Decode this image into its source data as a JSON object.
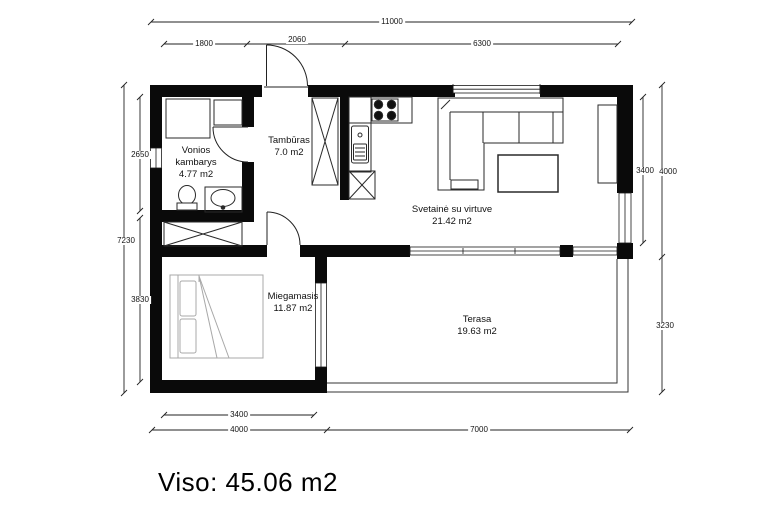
{
  "title": "House floor plan",
  "total": {
    "label": "Viso: 45.06 m2"
  },
  "rooms": {
    "bathroom": {
      "name": "Vonios kambarys",
      "area": "4.77 m2"
    },
    "hallway": {
      "name": "Tambūras",
      "area": "7.0 m2"
    },
    "living": {
      "name": "Svetainė su virtuve",
      "area": "21.42 m2"
    },
    "bedroom": {
      "name": "Miegamasis",
      "area": "11.87 m2"
    },
    "terrace": {
      "name": "Terasa",
      "area": "19.63 m2"
    }
  },
  "dimensions": {
    "top": {
      "total": "11000",
      "segments": [
        "1800",
        "2060",
        "6300"
      ]
    },
    "left": {
      "total": "7230",
      "segments": [
        "2650",
        "3830"
      ]
    },
    "right": {
      "room": "3400",
      "segments": [
        "4000",
        "3230"
      ]
    },
    "bottom": {
      "room": "3400",
      "segments": [
        "4000",
        "7000"
      ]
    }
  },
  "colors": {
    "wall": "#0a0a0a",
    "line": "#222222",
    "furniture_gray": "#a8a8a8"
  }
}
